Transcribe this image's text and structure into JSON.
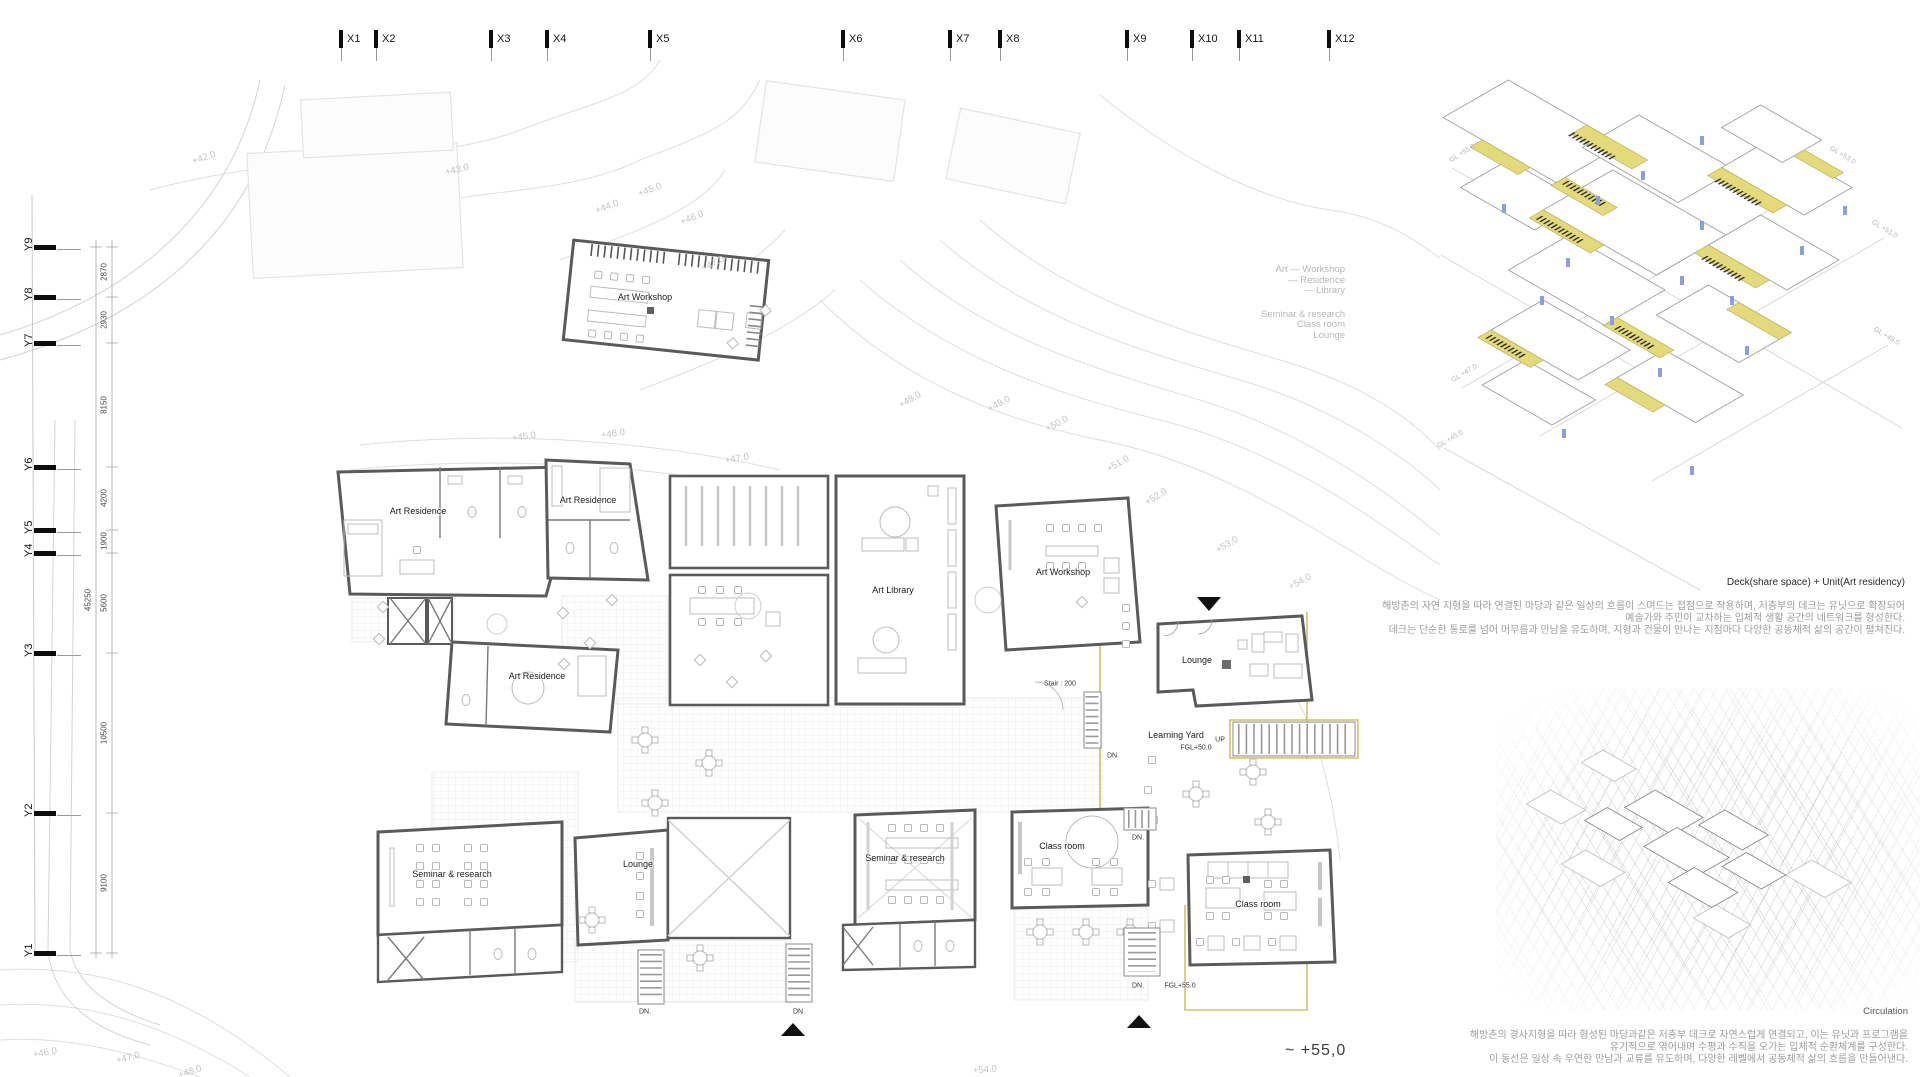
{
  "plan": {
    "x_axis": [
      {
        "label": "X1",
        "x": 348
      },
      {
        "label": "X2",
        "x": 383
      },
      {
        "label": "X3",
        "x": 498
      },
      {
        "label": "X4",
        "x": 554
      },
      {
        "label": "X5",
        "x": 657
      },
      {
        "label": "X6",
        "x": 850
      },
      {
        "label": "X7",
        "x": 957
      },
      {
        "label": "X8",
        "x": 1007
      },
      {
        "label": "X9",
        "x": 1134
      },
      {
        "label": "X10",
        "x": 1199
      },
      {
        "label": "X11",
        "x": 1246
      },
      {
        "label": "X12",
        "x": 1336
      }
    ],
    "y_axis": [
      {
        "label": "Y9",
        "y": 247
      },
      {
        "label": "Y8",
        "y": 297
      },
      {
        "label": "Y7",
        "y": 343
      },
      {
        "label": "Y6",
        "y": 467
      },
      {
        "label": "Y5",
        "y": 530
      },
      {
        "label": "Y4",
        "y": 553
      },
      {
        "label": "Y3",
        "y": 653
      },
      {
        "label": "Y2",
        "y": 813
      },
      {
        "label": "Y1",
        "y": 953
      }
    ],
    "dimensions": [
      {
        "value": "2870",
        "y": 272
      },
      {
        "value": "2930",
        "y": 320
      },
      {
        "value": "8150",
        "y": 405
      },
      {
        "value": "4200",
        "y": 498
      },
      {
        "value": "1900",
        "y": 541
      },
      {
        "value": "5600",
        "y": 603
      },
      {
        "value": "10500",
        "y": 733
      },
      {
        "value": "9100",
        "y": 883
      }
    ],
    "overall_dimension": {
      "value": "45250",
      "y": 600
    },
    "room_labels": [
      {
        "text": "Art Workshop",
        "x": 645,
        "y": 297
      },
      {
        "text": "Art Residence",
        "x": 418,
        "y": 511
      },
      {
        "text": "Art Residence",
        "x": 588,
        "y": 500
      },
      {
        "text": "Art Residence",
        "x": 537,
        "y": 676
      },
      {
        "text": "Art Library",
        "x": 893,
        "y": 590
      },
      {
        "text": "Art Workshop",
        "x": 1063,
        "y": 572
      },
      {
        "text": "Lounge",
        "x": 1197,
        "y": 660
      },
      {
        "text": "Learning Yard",
        "x": 1176,
        "y": 735
      },
      {
        "text": "Lounge",
        "x": 638,
        "y": 864
      },
      {
        "text": "Seminar & research",
        "x": 452,
        "y": 874
      },
      {
        "text": "Seminar & research",
        "x": 905,
        "y": 858
      },
      {
        "text": "Class room",
        "x": 1062,
        "y": 846
      },
      {
        "text": "Class room",
        "x": 1258,
        "y": 904
      }
    ],
    "small_labels": [
      {
        "text": "Stair : 200",
        "x": 1060,
        "y": 684
      },
      {
        "text": "UP",
        "x": 1220,
        "y": 740
      },
      {
        "text": "DN.",
        "x": 1113,
        "y": 756
      },
      {
        "text": "DN.",
        "x": 645,
        "y": 1012
      },
      {
        "text": "DN.",
        "x": 799,
        "y": 1012
      },
      {
        "text": "DN.",
        "x": 1138,
        "y": 838
      },
      {
        "text": "DN.",
        "x": 1138,
        "y": 986
      },
      {
        "text": "FGL+50.0",
        "x": 1196,
        "y": 748
      },
      {
        "text": "FGL+55.0",
        "x": 1180,
        "y": 986
      }
    ],
    "contour_labels": [
      {
        "text": "+42.0",
        "x": 204,
        "y": 158,
        "r": -18
      },
      {
        "text": "+43.0",
        "x": 457,
        "y": 170,
        "r": -14
      },
      {
        "text": "+44.0",
        "x": 607,
        "y": 207,
        "r": -20
      },
      {
        "text": "+45.0",
        "x": 650,
        "y": 190,
        "r": -20
      },
      {
        "text": "+46.0",
        "x": 692,
        "y": 218,
        "r": -22
      },
      {
        "text": "+47.0",
        "x": 713,
        "y": 264,
        "r": -26
      },
      {
        "text": "+48.0",
        "x": 910,
        "y": 400,
        "r": -30
      },
      {
        "text": "+49.0",
        "x": 999,
        "y": 404,
        "r": -28
      },
      {
        "text": "+50.0",
        "x": 1057,
        "y": 424,
        "r": -28
      },
      {
        "text": "+45.0",
        "x": 524,
        "y": 437,
        "r": -8
      },
      {
        "text": "+46.0",
        "x": 613,
        "y": 434,
        "r": -8
      },
      {
        "text": "+47.0",
        "x": 737,
        "y": 459,
        "r": -10
      },
      {
        "text": "+51.0",
        "x": 1118,
        "y": 464,
        "r": -30
      },
      {
        "text": "+52.0",
        "x": 1156,
        "y": 497,
        "r": -32
      },
      {
        "text": "+53.0",
        "x": 1227,
        "y": 545,
        "r": -30
      },
      {
        "text": "+54.0",
        "x": 1300,
        "y": 582,
        "r": -28
      },
      {
        "text": "+54.0",
        "x": 985,
        "y": 1070,
        "r": -5
      },
      {
        "text": "+46.0",
        "x": 45,
        "y": 1053,
        "r": -10
      },
      {
        "text": "+47.0",
        "x": 128,
        "y": 1058,
        "r": -14
      },
      {
        "text": "+48.0",
        "x": 190,
        "y": 1072,
        "r": -18
      }
    ],
    "level_note": "~ +55,0"
  },
  "legend": {
    "lines": [
      "Art — Workshop",
      "— Residence",
      "— Library",
      "",
      "Seminar & research",
      "Class room",
      "Lounge"
    ]
  },
  "axon_deck": {
    "caption": "Deck(share space) + Unit(Art residency)",
    "description_lines": [
      "해방촌의 자연 지형을 따라 연결된 마당과 같은 일상의 흐름이 스며드는 접점으로 작용하며, 저층부의 데크는 유닛으로 확장되어",
      "예술가와 주민이 교차하는 입체적 생활 공간의 네트워크를 형성한다.",
      "데크는 단순한 통로를 넘어 머무름과 만남을 유도하며, 지형과 건물이 만나는 지점마다 다양한 공동체적 삶의 공간이 펼쳐진다."
    ],
    "gl_labels": [
      {
        "text": "GL +55.0",
        "x": 1448,
        "y": 150,
        "r": -31
      },
      {
        "text": "GL +53.0",
        "x": 1828,
        "y": 152,
        "r": 31
      },
      {
        "text": "GL +51.0",
        "x": 1870,
        "y": 226,
        "r": 31
      },
      {
        "text": "GL +49.0",
        "x": 1872,
        "y": 333,
        "r": 31
      },
      {
        "text": "GL +47.0",
        "x": 1450,
        "y": 370,
        "r": -31
      },
      {
        "text": "GL +45.0",
        "x": 1436,
        "y": 436,
        "r": -31
      }
    ]
  },
  "axon_circulation": {
    "caption": "Circulation",
    "description_lines": [
      "해방촌의 경사지형을 따라 형성된 마당과같은  저층부 데크로 자연스럽게 연결되고, 이는 유닛과 프로그램을",
      "유기적으로 엮어내며 수평과 수직을 오가는 입체적 순환체계를 구성한다.",
      "이 동선은 일상 속 우연한 만남과 교류를 유도하며, 다양한 레벨에서 공동체적 삶의 흐름을 만들어낸다."
    ]
  },
  "colors": {
    "accent_yellow": "#e3da7b",
    "yellow_line": "#cfc169",
    "wall": "#5a5a5a",
    "contour": "#dedede",
    "figure_blue": "#8d9ed8",
    "gray_text": "#b7b7b7"
  }
}
